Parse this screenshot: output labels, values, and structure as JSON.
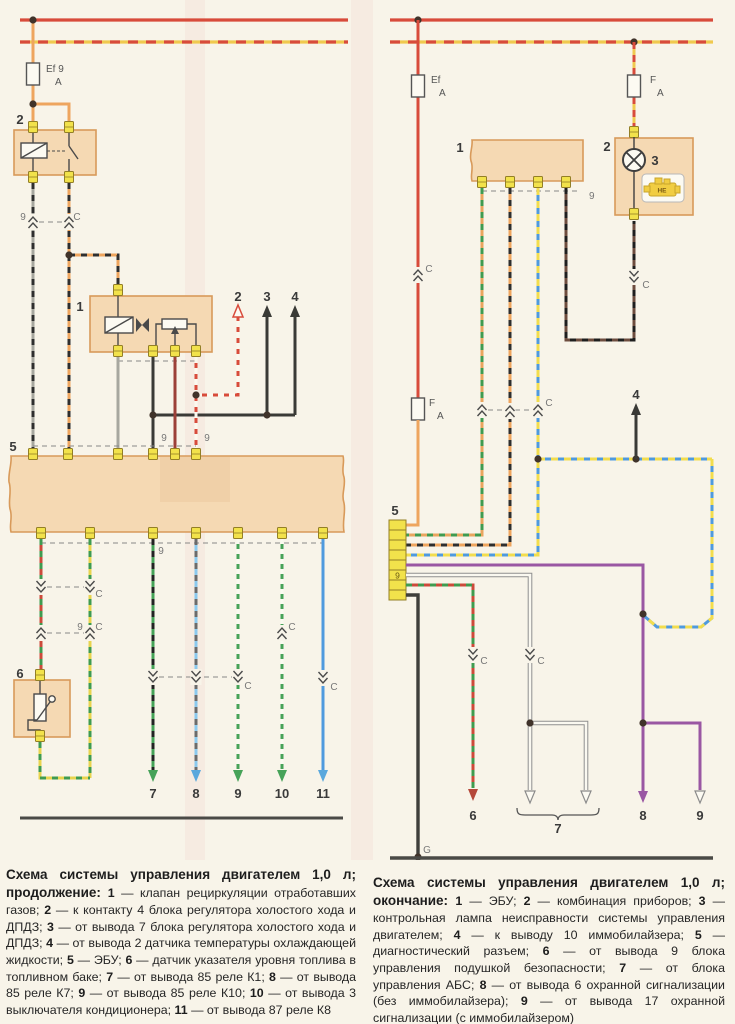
{
  "palette": {
    "paper": "#f8f4e9",
    "box_fill": "#f5d9b3",
    "box_border": "#d89a5a",
    "pin_fill": "#f2e24b",
    "red": "#d84b3b",
    "orange": "#eea55e",
    "yellow": "#f0c94f",
    "green": "#46a258",
    "light_blue": "#7cc2ea",
    "blue": "#4f9ade",
    "purple": "#9a57a3",
    "maroon": "#9c4038",
    "brown": "#6d4c3e",
    "gray": "#a7a79f",
    "black": "#3a3a36"
  },
  "labels": {
    "c": "C",
    "amp": "A",
    "g": "G",
    "ef9": "Ef 9",
    "ef": "Ef",
    "f": "F",
    "he": "HE",
    "n1": "1",
    "n2": "2",
    "n3": "3",
    "n4": "4",
    "n5": "5",
    "n6": "6",
    "n7": "7",
    "n8": "8",
    "n9": "9",
    "n10": "10",
    "n11": "11"
  },
  "left_caption": {
    "segments": [
      {
        "b": 1,
        "cls": "cap-title",
        "t": "Схема системы управления двигателем 1,0 л; продолжение: "
      },
      {
        "b": 1,
        "t": "1"
      },
      {
        "t": " — клапан рециркуляции отработавших газов; "
      },
      {
        "b": 1,
        "t": "2"
      },
      {
        "t": " — к контакту 4 блока регулятора холостого хода и ДПДЗ; "
      },
      {
        "b": 1,
        "t": "3"
      },
      {
        "t": " — от вывода 7 блока регулятора холостого хода и ДПДЗ; "
      },
      {
        "b": 1,
        "t": "4"
      },
      {
        "t": " — от вывода 2 датчика температуры охлаждающей жидкости; "
      },
      {
        "b": 1,
        "t": "5"
      },
      {
        "t": " — ЭБУ; "
      },
      {
        "b": 1,
        "t": "6"
      },
      {
        "t": " — датчик указателя уровня топлива в топливном баке; "
      },
      {
        "b": 1,
        "t": "7"
      },
      {
        "t": " — от вывода 85 реле К1; "
      },
      {
        "b": 1,
        "t": "8"
      },
      {
        "t": " — от вывода 85 реле К7; "
      },
      {
        "b": 1,
        "t": "9"
      },
      {
        "t": " — от вывода 85 реле К10; "
      },
      {
        "b": 1,
        "t": "10"
      },
      {
        "t": " — от вывода 3 выключателя кондиционера; "
      },
      {
        "b": 1,
        "t": "11"
      },
      {
        "t": " — от вывода 87 реле К8"
      }
    ]
  },
  "right_caption": {
    "segments": [
      {
        "b": 1,
        "cls": "cap-title",
        "t": "Схема системы управления двигателем 1,0 л; окончание: "
      },
      {
        "b": 1,
        "t": "1"
      },
      {
        "t": " — ЭБУ; "
      },
      {
        "b": 1,
        "t": "2"
      },
      {
        "t": " — комбинация приборов; "
      },
      {
        "b": 1,
        "t": "3"
      },
      {
        "t": " — контрольная лампа неисправности системы управления двигателем; "
      },
      {
        "b": 1,
        "t": "4"
      },
      {
        "t": " — к выводу 10 иммобилайзера; "
      },
      {
        "b": 1,
        "t": "5"
      },
      {
        "t": " — диагностический разъем; "
      },
      {
        "b": 1,
        "t": "6"
      },
      {
        "t": " — от вывода 9 блока управления подушкой безопасности; "
      },
      {
        "b": 1,
        "t": "7"
      },
      {
        "t": " — от блока управления АБС; "
      },
      {
        "b": 1,
        "t": "8"
      },
      {
        "t": " — от вывода 6 охранной сигнализации (без иммобилайзера); "
      },
      {
        "b": 1,
        "t": "9"
      },
      {
        "t": " — от вывода 17 охранной сигнализации (с иммобилайзером)"
      }
    ]
  }
}
